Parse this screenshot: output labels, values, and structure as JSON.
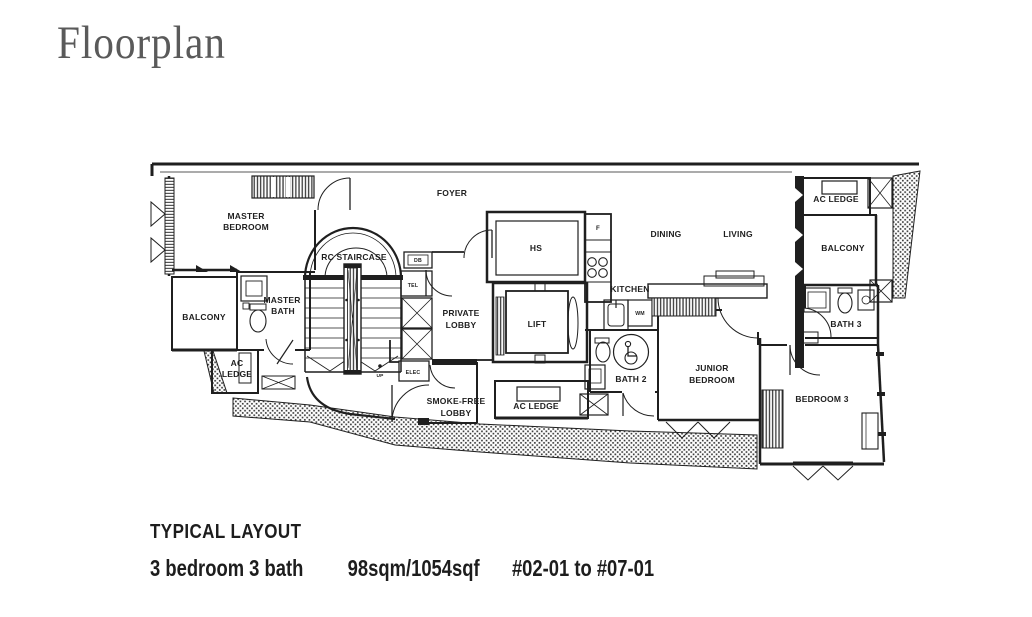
{
  "title": "Floorplan",
  "footer": {
    "heading": "TYPICAL LAYOUT",
    "spec": "3 bedroom 3 bath",
    "area": "98sqm/1054sqf",
    "units": "#02-01 to #07-01"
  },
  "colors": {
    "ink": "#1f1f1f",
    "title_gray": "#5a5a5a"
  },
  "rooms": {
    "master_bedroom": [
      "MASTER",
      "BEDROOM"
    ],
    "foyer": "FOYER",
    "rc_staircase": "RC STAIRCASE",
    "master_bath": [
      "MASTER",
      "BATH"
    ],
    "balcony_left": "BALCONY",
    "ac_ledge_left": [
      "AC",
      "LEDGE"
    ],
    "private_lobby": [
      "PRIVATE",
      "LOBBY"
    ],
    "lift": "LIFT",
    "hs": "HS",
    "smoke_free_lobby": [
      "SMOKE-FREE",
      "LOBBY"
    ],
    "ac_ledge_center": "AC LEDGE",
    "dining": "DINING",
    "living": "LIVING",
    "kitchen": "KITCHEN",
    "ac_ledge_right": "AC LEDGE",
    "balcony_right": "BALCONY",
    "bath_3": "BATH 3",
    "junior_bedroom": [
      "JUNIOR",
      "BEDROOM"
    ],
    "bedroom_3": "BEDROOM 3",
    "bath_2": "BATH 2"
  },
  "utilities": {
    "db": "DB",
    "tel": "TEL",
    "elec": "ELEC",
    "fridge": "F",
    "washing_machine": "WM",
    "up": "UP"
  }
}
